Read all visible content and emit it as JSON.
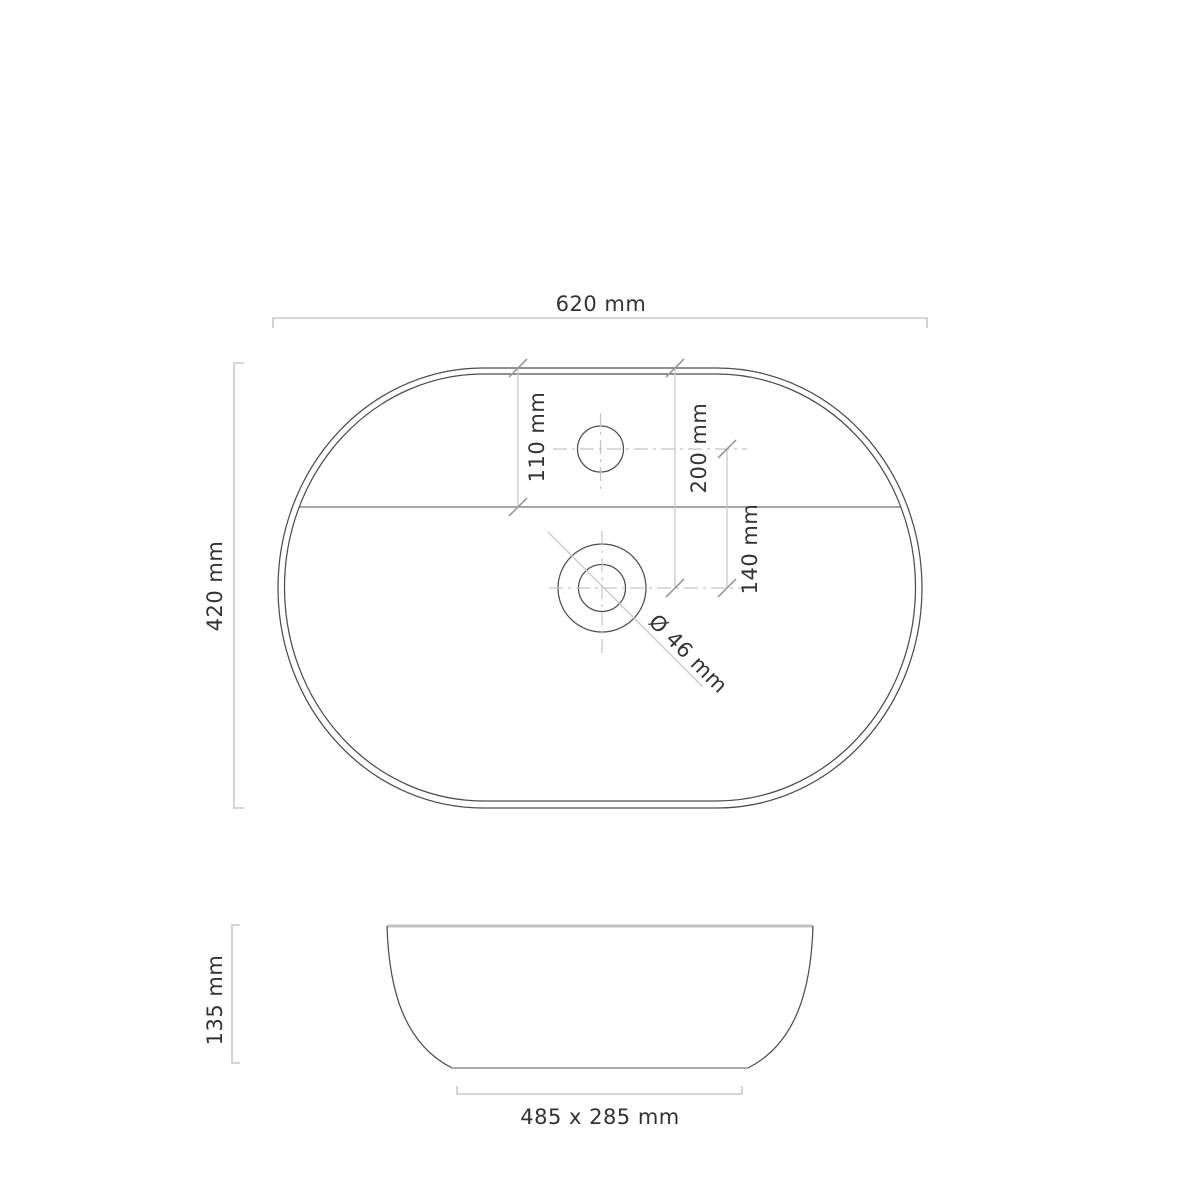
{
  "drawing": {
    "product": "oval-countertop-washbasin",
    "views": {
      "top_view": "plan view",
      "side_view": "front elevation"
    },
    "labels": {
      "top_width": "620 mm",
      "top_height": "420 mm",
      "tap_hole_offset": "110 mm",
      "drain_offset": "200 mm",
      "tap_to_drain": "140 mm",
      "drain_diameter": "Ø 46 mm",
      "side_height": "135 mm",
      "base_size": "485 x 285 mm"
    },
    "dimensions_mm": {
      "width": 620,
      "depth": 420,
      "height": 135,
      "tap_hole_offset": 110,
      "drain_offset": 200,
      "tap_to_drain": 140,
      "drain_diameter": 46,
      "base_width": 485,
      "base_depth": 285
    },
    "colors": {
      "background": "#ffffff",
      "outline": "#4d4d4d",
      "dimension_lines": "#c9c9c9",
      "text": "#333333"
    }
  }
}
